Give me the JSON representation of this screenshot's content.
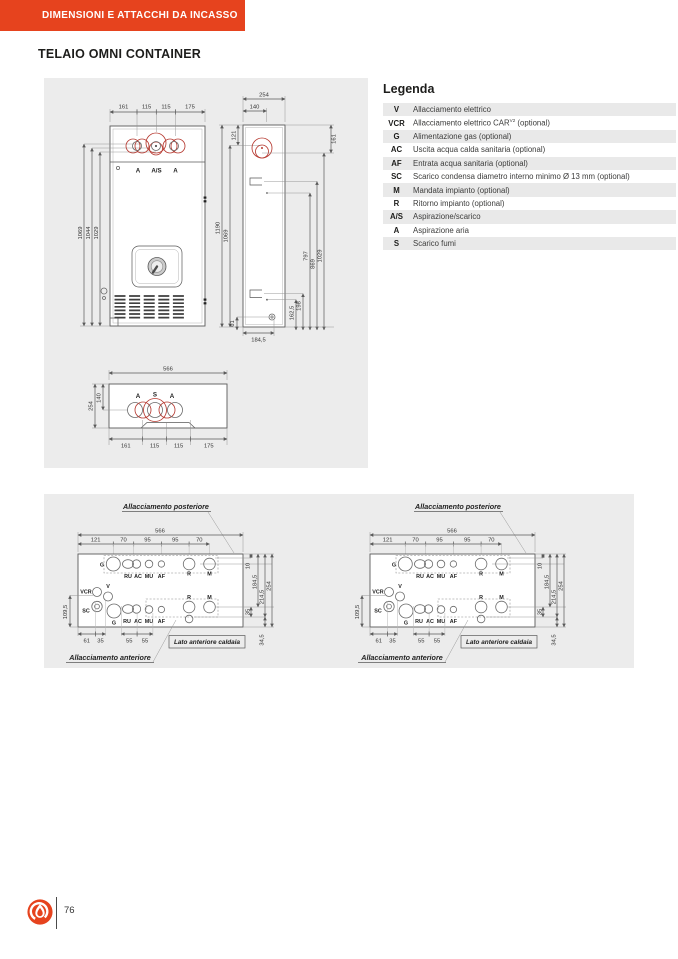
{
  "header": {
    "banner": "DIMENSIONI E ATTACCHI DA INCASSO"
  },
  "title": "TELAIO OMNI CONTAINER",
  "legend": {
    "title": "Legenda",
    "items": [
      {
        "abbr": "V",
        "desc": "Allacciamento elettrico"
      },
      {
        "abbr": "VCR",
        "desc": "Allacciamento elettrico CAR",
        "sup": "V2",
        "desc2": " (optional)"
      },
      {
        "abbr": "G",
        "desc": "Alimentazione gas (optional)"
      },
      {
        "abbr": "AC",
        "desc": "Uscita acqua calda sanitaria (optional)"
      },
      {
        "abbr": "AF",
        "desc": "Entrata acqua sanitaria (optional)"
      },
      {
        "abbr": "SC",
        "desc": "Scarico condensa diametro interno minimo Ø 13 mm (optional)"
      },
      {
        "abbr": "M",
        "desc": "Mandata impianto (optional)"
      },
      {
        "abbr": "R",
        "desc": "Ritorno impianto (optional)"
      },
      {
        "abbr": "A/S",
        "desc": "Aspirazione/scarico"
      },
      {
        "abbr": "A",
        "desc": "Aspirazione aria"
      },
      {
        "abbr": "S",
        "desc": "Scarico fumi"
      }
    ]
  },
  "td": {
    "front": {
      "top_dims": [
        "161",
        "115",
        "115",
        "175"
      ],
      "left_dims": [
        "1069",
        "1044",
        "1029"
      ],
      "ports": [
        "A",
        "A/S",
        "A"
      ]
    },
    "side": {
      "w254": "254",
      "w140": "140",
      "d121": "121",
      "h1190": "1190",
      "h1069": "1069",
      "r161": "161",
      "d797": "797",
      "d869": "869",
      "d1029": "1029",
      "d61": "61",
      "d1845": "184,5",
      "d1625": "162,5",
      "d198": "198"
    },
    "plan": {
      "w566": "566",
      "d254": "254",
      "d140": "140",
      "labels": [
        "A",
        "S",
        "A"
      ],
      "bot": [
        "161",
        "115",
        "115",
        "175"
      ]
    }
  },
  "bd": {
    "post": "Allacciamento posteriore",
    "ant": "Allacciamento anteriore",
    "lato": "Lato anteriore caldaia",
    "w566": "566",
    "sub": [
      "121",
      "70",
      "95",
      "95",
      "70"
    ],
    "r10": "10",
    "r1845": "184,5",
    "r2145": "214,5",
    "r254": "254",
    "r35": "35",
    "r345": "34,5",
    "l1095": "109,5",
    "bot": [
      "61",
      "35",
      "55",
      "55"
    ],
    "back": [
      "G",
      "RU",
      "AC",
      "MU",
      "AF",
      "R",
      "M"
    ],
    "front_row": [
      "VCR",
      "V",
      "SC",
      "G",
      "RU",
      "AC",
      "MU",
      "AF",
      "R",
      "M"
    ]
  },
  "footer": {
    "page": "76"
  },
  "colors": {
    "accent": "#e6431e",
    "panel": "#ececec",
    "drawing_red": "#b63a31"
  }
}
